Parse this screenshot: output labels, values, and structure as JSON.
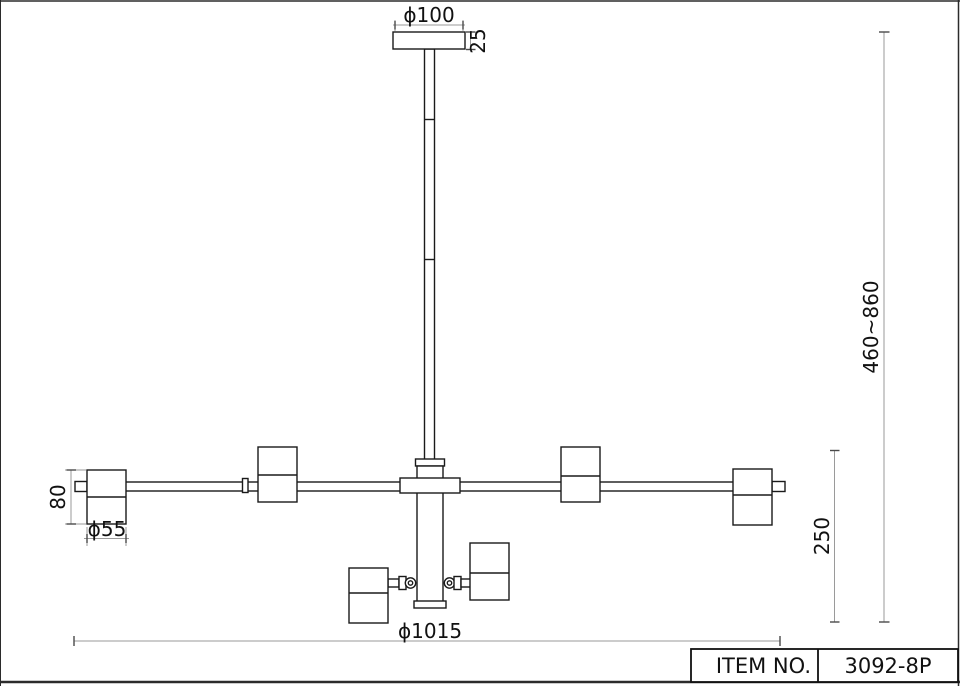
{
  "drawing": {
    "type": "technical dimension drawing",
    "subject": "8-light spot chandelier side view",
    "dimensions": {
      "canopy_diameter": "ϕ100",
      "canopy_height": "25",
      "suspension_range": "460~860",
      "drop_height": "250",
      "shade_height": "80",
      "shade_diameter": "ϕ55",
      "fixture_width": "ϕ1015"
    },
    "title_block": {
      "label": "ITEM NO.",
      "value": "3092-8P"
    },
    "colors": {
      "background": "#ffffff",
      "fixture_line": "#1a1a1a",
      "dimension_line": "#9a9a9a",
      "text": "#111111"
    }
  }
}
